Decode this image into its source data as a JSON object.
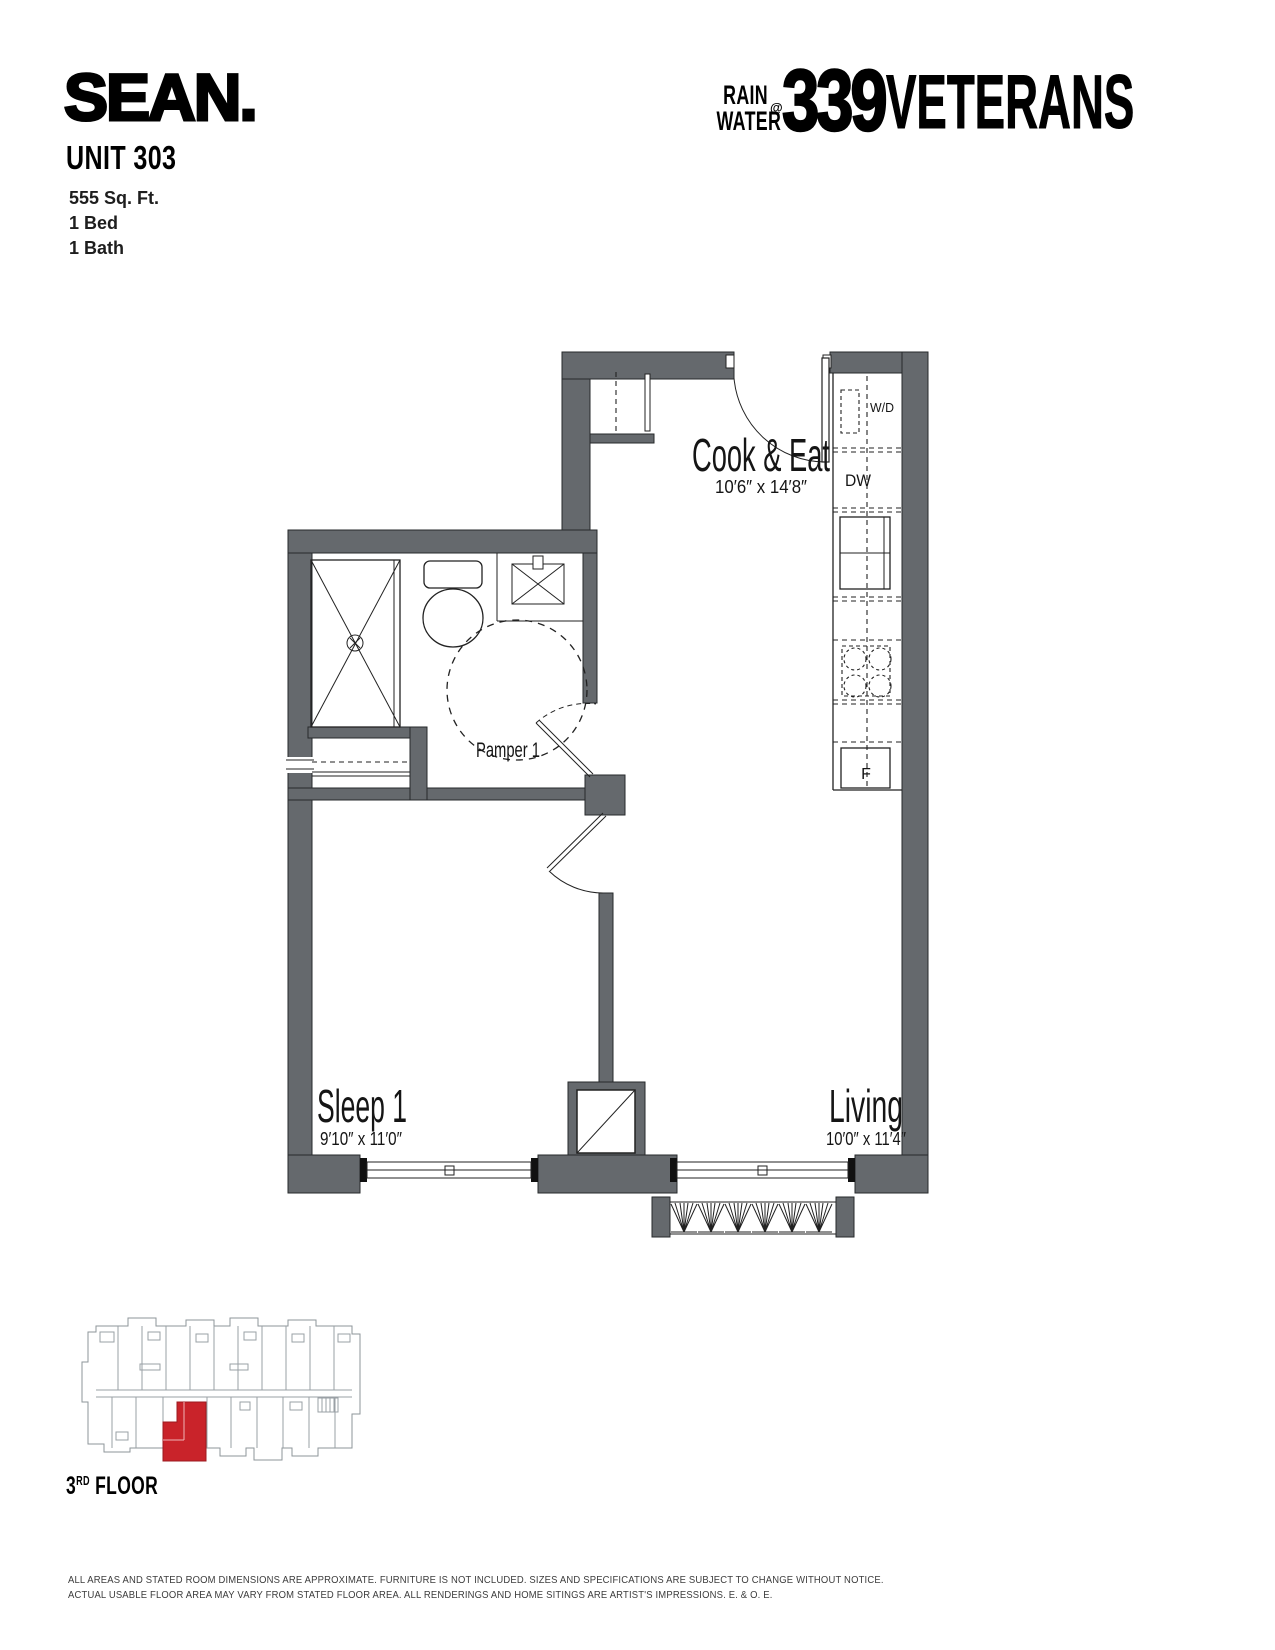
{
  "header": {
    "brand": "SEAN.",
    "unit_title": "UNIT 303",
    "details": [
      "555 Sq. Ft.",
      "1 Bed",
      "1 Bath"
    ],
    "building_logo": {
      "line1": "RAIN",
      "line2": "WATER",
      "at": "@",
      "number": "339",
      "name": "VETERANS"
    }
  },
  "floorplan": {
    "rooms": [
      {
        "name": "Cook & Eat",
        "dims": "10′6″ x 14′8″"
      },
      {
        "name": "Pamper 1",
        "dims": ""
      },
      {
        "name": "Sleep 1",
        "dims": "9′10″ x 11′0″"
      },
      {
        "name": "Living",
        "dims": "10′0″ x 11′4″"
      }
    ],
    "appliances": {
      "washer_dryer": "W/D",
      "dishwasher": "DW",
      "fridge": "F"
    }
  },
  "keyplan": {
    "floor_number": "3",
    "floor_ordinal": "RD",
    "floor_word": " FLOOR"
  },
  "disclaimer": {
    "line1": "ALL AREAS AND STATED ROOM DIMENSIONS ARE APPROXIMATE. FURNITURE IS NOT INCLUDED. SIZES AND SPECIFICATIONS ARE SUBJECT TO CHANGE WITHOUT NOTICE.",
    "line2": "ACTUAL USABLE FLOOR AREA MAY VARY FROM STATED FLOOR AREA. ALL RENDERINGS AND HOME SITINGS ARE ARTIST'S IMPRESSIONS. E. & O. E."
  },
  "colors": {
    "wall_gray": "#65696d",
    "keyplan_line": "#9aa0a5",
    "unit_highlight_red": "#c9232a"
  }
}
